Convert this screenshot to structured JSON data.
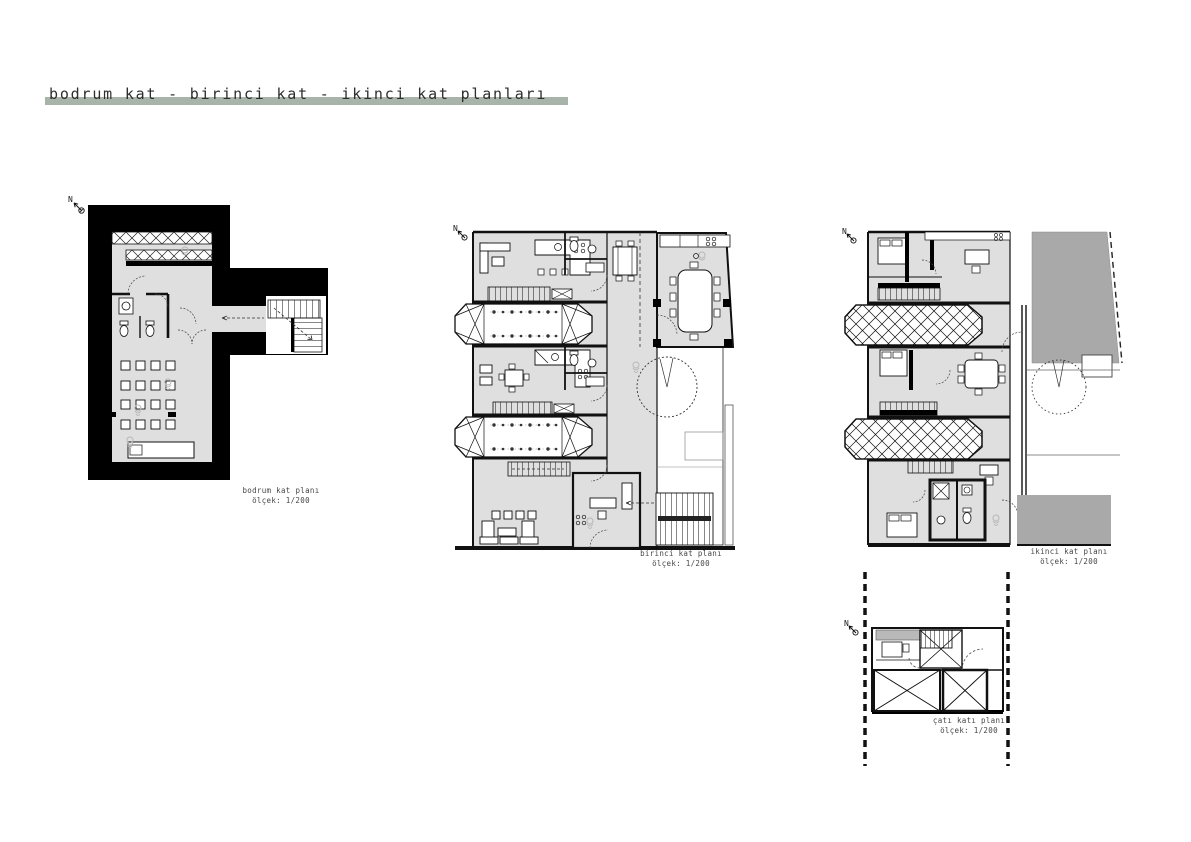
{
  "title": {
    "text": "bodrum kat - birinci kat - ikinci kat planları",
    "underline_color": "#a8b4aa"
  },
  "colors": {
    "poche_black": "#000000",
    "floor_gray": "#dfdfdf",
    "roof_gray": "#a9a9a9",
    "line_black": "#111111",
    "sketch_gray": "#b9b9b9",
    "accent_bar": "#a8b4aa"
  },
  "plans": [
    {
      "name": "bodrum kat planı",
      "scale": "ölçek: 1/200",
      "north_label": "N"
    },
    {
      "name": "birinci kat planı",
      "scale": "ölçek: 1/200",
      "north_label": "N"
    },
    {
      "name": "ikinci kat planı",
      "scale": "ölçek: 1/200",
      "north_label": "N"
    },
    {
      "name": "çatı katı planı",
      "scale": "ölçek: 1/200",
      "north_label": "N"
    }
  ]
}
